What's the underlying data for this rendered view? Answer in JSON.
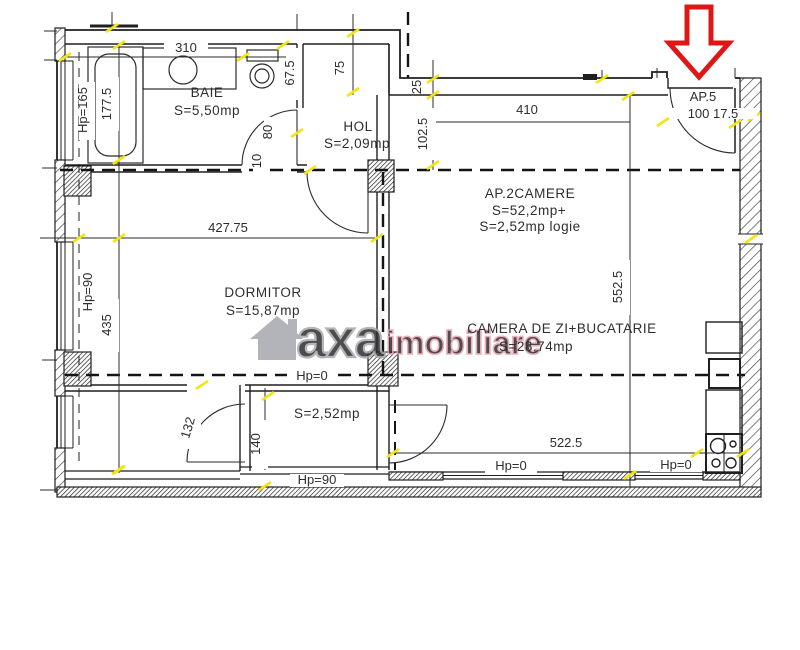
{
  "plan": {
    "apartment_label": {
      "line1": "AP.2CAMERE",
      "line2": "S=52,2mp+",
      "line3": "S=2,52mp  logie"
    },
    "entrance": {
      "name": "AP.5",
      "dims": "100  17.5"
    },
    "rooms": {
      "baie": {
        "name": "BAIE",
        "area": "S=5,50mp"
      },
      "hol": {
        "name": "HOL",
        "area": "S=2,09mp"
      },
      "dormitor": {
        "name": "DORMITOR",
        "area": "S=15,87mp"
      },
      "living": {
        "name": "CAMERA DE ZI+BUCATARIE",
        "area": "S=28,74mp"
      },
      "logie": {
        "area": "S=2,52mp"
      }
    },
    "dims": {
      "w310": "310",
      "h177": "177.5",
      "hp165": "Hp=165",
      "t67": "67.5",
      "s75": "75",
      "d80": "80",
      "d10": "10",
      "s25": "25",
      "s102": "102.5",
      "w410": "410",
      "w427": "427.75",
      "hp90w": "Hp=90",
      "h435": "435",
      "h552": "552.5",
      "hp0c": "Hp=0",
      "d132": "132",
      "d140": "140",
      "hp90l": "Hp=90",
      "w522": "522.5",
      "hp0l": "Hp=0",
      "hp0r": "Hp=0"
    }
  },
  "watermark": {
    "brand": "axa",
    "suffix": "imobiliare"
  },
  "colors": {
    "arrow": "#e01616",
    "tick": "#f3e512",
    "wm_gray": "#a6a6ae",
    "wm_pink": "#e8a3b3",
    "line": "#1f1f1f"
  }
}
